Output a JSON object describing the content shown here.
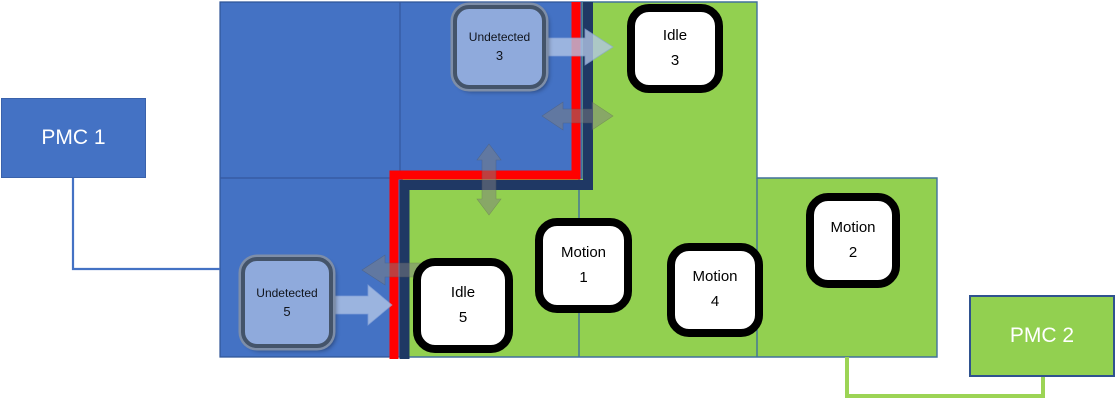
{
  "pmc1": {
    "label": "PMC 1"
  },
  "pmc2": {
    "label": "PMC 2"
  },
  "states": [
    {
      "id": "undetected3",
      "name": "Undetected",
      "num": "3",
      "kind": "undetected"
    },
    {
      "id": "idle3",
      "name": "Idle",
      "num": "3",
      "kind": "normal"
    },
    {
      "id": "undetected5",
      "name": "Undetected",
      "num": "5",
      "kind": "undetected"
    },
    {
      "id": "idle5",
      "name": "Idle",
      "num": "5",
      "kind": "normal"
    },
    {
      "id": "motion1",
      "name": "Motion",
      "num": "1",
      "kind": "normal"
    },
    {
      "id": "motion4",
      "name": "Motion",
      "num": "4",
      "kind": "normal"
    },
    {
      "id": "motion2",
      "name": "Motion",
      "num": "2",
      "kind": "normal"
    }
  ],
  "icons": [
    "right-arrow-icon-undetected3-to-idle3",
    "double-horizontal-arrow-icon-blue-green-top",
    "double-vertical-arrow-icon-blue-green-middle",
    "left-arrow-icon-green-to-blue-bottom",
    "right-arrow-icon-undetected5-to-idle5"
  ],
  "colors": {
    "pmc1_region_blue": "#4472C4",
    "pmc2_region_green": "#92D050",
    "boundary_red": "#FF0000",
    "boundary_navy": "#1F3864",
    "undetected_fill": "#8FAADC",
    "undetected_border": "#44546A",
    "state_fill": "#FFFFFF",
    "state_border": "#000000",
    "blue_arrow": "#B4C7E7",
    "gray_arrow": "#7F7F7F",
    "cell_line_blue": "#3B5EA9",
    "cell_line_green_region": "#41719C",
    "pmc2_connector_green": "#9CD455"
  }
}
